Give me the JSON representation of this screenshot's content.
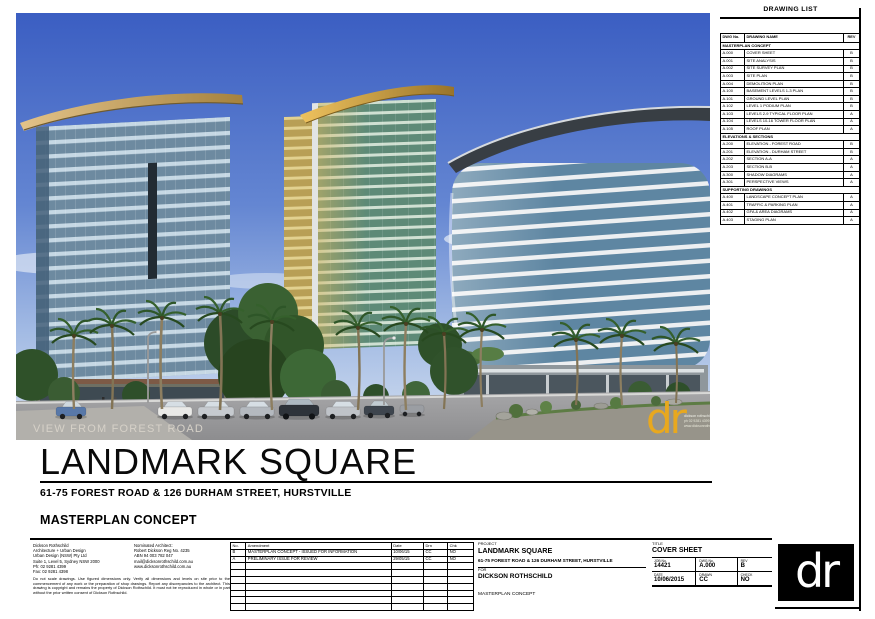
{
  "page": {
    "title": "LANDMARK SQUARE",
    "subtitle": "61-75 FOREST ROAD & 126 DURHAM STREET, HURSTVILLE",
    "concept_label": "MASTERPLAN CONCEPT"
  },
  "photo": {
    "caption": "VIEW FROM FOREST ROAD",
    "watermark_logo": "dr",
    "watermark_lines": [
      "dickson rothschild",
      "ph 02 9281 4399",
      "www.dicksonrothschild.com.au"
    ]
  },
  "drawing_list": {
    "heading": "DRAWING LIST",
    "columns": [
      "DWG No.",
      "DRAWING NAME",
      "REV"
    ],
    "sections": [
      {
        "label": "MASTERPLAN CONCEPT",
        "rows": [
          [
            "A.000",
            "COVER SHEET",
            "B"
          ],
          [
            "A.001",
            "SITE ANALYSIS",
            "B"
          ],
          [
            "A.002",
            "SITE SURVEY PLAN",
            "B"
          ],
          [
            "A.003",
            "SITE PLAN",
            "B"
          ],
          [
            "A.004",
            "DEMOLITION PLAN",
            "B"
          ],
          [
            "A.100",
            "BASEMENT LEVELS 1-3 PLAN",
            "B"
          ],
          [
            "A.101",
            "GROUND LEVEL PLAN",
            "B"
          ],
          [
            "A.102",
            "LEVEL 1 PODIUM PLAN",
            "B"
          ],
          [
            "A.103",
            "LEVELS 2-9 TYPICAL FLOOR PLAN",
            "A"
          ],
          [
            "A.104",
            "LEVELS 10-16 TOWER FLOOR PLAN",
            "A"
          ],
          [
            "A.105",
            "ROOF PLAN",
            "A"
          ]
        ]
      },
      {
        "label": "ELEVATIONS & SECTIONS",
        "rows": [
          [
            "A.200",
            "ELEVATION - FOREST ROAD",
            "B"
          ],
          [
            "A.201",
            "ELEVATION - DURHAM STREET",
            "B"
          ],
          [
            "A.202",
            "SECTION A-A",
            "A"
          ],
          [
            "A.203",
            "SECTION B-B",
            "A"
          ],
          [
            "A.300",
            "SHADOW DIAGRAMS",
            "A"
          ],
          [
            "A.301",
            "PERSPECTIVE VIEWS",
            "A"
          ]
        ]
      },
      {
        "label": "SUPPORTING DRAWINGS",
        "rows": [
          [
            "A.400",
            "LANDSCAPE CONCEPT PLAN",
            "A"
          ],
          [
            "A.401",
            "TRAFFIC & PARKING PLAN",
            "A"
          ],
          [
            "A.402",
            "GFA & AREA DIAGRAMS",
            "A"
          ],
          [
            "A.403",
            "STAGING PLAN",
            "A"
          ]
        ]
      }
    ]
  },
  "revision_table": {
    "columns": [
      "No.",
      "Amendment",
      "Date",
      "Drn",
      "Chk"
    ],
    "rows": [
      [
        "B",
        "MASTERPLAN CONCEPT - ISSUED FOR INFORMATION",
        "10/06/15",
        "CC",
        "NO"
      ],
      [
        "A",
        "PRELIMINARY ISSUE FOR REVIEW",
        "29/05/15",
        "CC",
        "NO"
      ],
      [
        "",
        "",
        "",
        "",
        ""
      ],
      [
        "",
        "",
        "",
        "",
        ""
      ],
      [
        "",
        "",
        "",
        "",
        ""
      ],
      [
        "",
        "",
        "",
        "",
        ""
      ],
      [
        "",
        "",
        "",
        "",
        ""
      ],
      [
        "",
        "",
        "",
        "",
        ""
      ],
      [
        "",
        "",
        "",
        "",
        ""
      ]
    ]
  },
  "title_block": {
    "architect": {
      "col1": [
        "Dickson Rothschild",
        "Architecture + Urban Design",
        "Urban Design (NSW) Pty Ltd",
        "Suite 1, Level 5, Sydney NSW 2000",
        "Ph: 02 9281 4399",
        "Fax: 02 9281 4398"
      ],
      "col2": [
        "Nominated Architect:",
        "Robert Dickson Reg No. 4235",
        "ABN 94 003 782 047",
        "mail@dicksonrothschild.com.au",
        "www.dicksonrothschild.com.au"
      ],
      "disclaimer": "Do not scale drawings. Use figured dimensions only. Verify all dimensions and levels on site prior to the commencement of any work or the preparation of shop drawings. Report any discrepancies to the architect. This drawing is copyright and remains the property of Dickson Rothschild. It must not be reproduced in whole or in part without the prior written consent of Dickson Rothschild."
    },
    "project_label": "PROJECT",
    "project_name": "LANDMARK SQUARE",
    "project_address": "61-75 FOREST ROAD & 126 DURHAM STREET, HURSTVILLE",
    "client_label": "FOR",
    "client": "DICKSON ROTHSCHILD",
    "stage": "MASTERPLAN CONCEPT",
    "sheet_title_label": "TITLE",
    "sheet_title": "COVER SHEET",
    "fields": {
      "job_label": "JOB No.",
      "job": "14421",
      "dwg_label": "DWG No.",
      "dwg": "A.000",
      "rev_label": "REV",
      "rev": "B",
      "date_label": "DATE",
      "date": "10/06/2015",
      "drawn_label": "DRAWN",
      "drawn": "CC",
      "check_label": "CHECK",
      "check": "NO"
    },
    "logo_text": "dr"
  },
  "colors": {
    "sky_top": "#3b5ec2",
    "canopy_tan": "#d9b87a",
    "canopy_gold": "#e0b054",
    "tower_glass_blue": "#6d8aa0",
    "tower_glass_green": "#5d8a77",
    "tower3_glass": "#5e86a2",
    "watermark_yellow": "#e8a81e"
  }
}
